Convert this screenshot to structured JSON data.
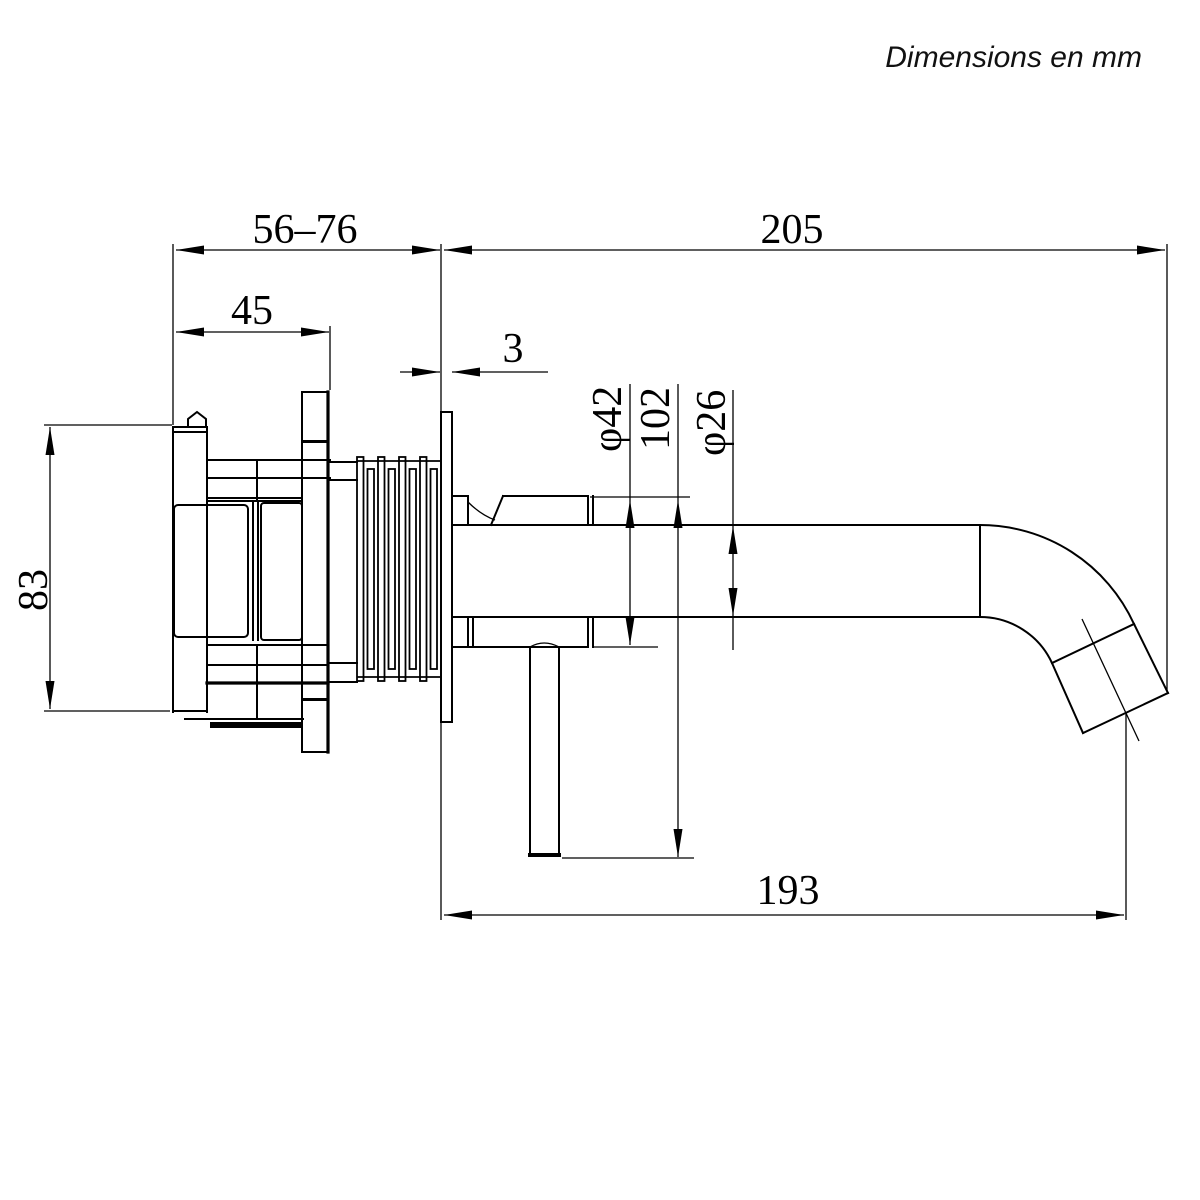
{
  "note": "Dimensions en mm",
  "colors": {
    "line": "#000000",
    "background": "#ffffff"
  },
  "dimensions": {
    "installation_depth": "56–76",
    "total_projection": "205",
    "body_width": "45",
    "plate_thickness": "3",
    "body_height": "83",
    "escutcheon_diameter": "φ42",
    "handle_height": "102",
    "spout_diameter": "φ26",
    "spout_reach": "193"
  }
}
